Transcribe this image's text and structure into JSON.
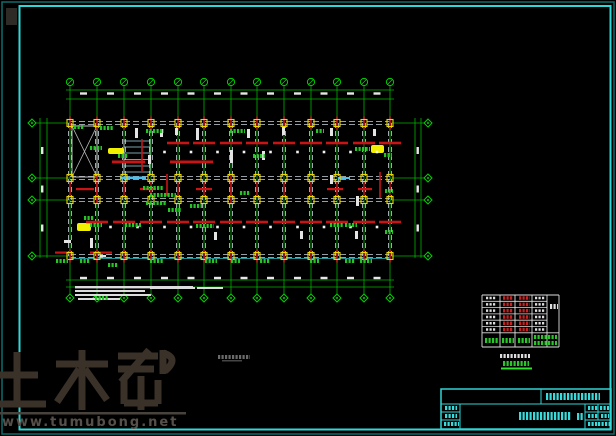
{
  "watermark": {
    "logo_text": "土木帮",
    "site_url": "www.tumubong.net",
    "logo_color": "#3a3129",
    "url_color": "#57504a"
  },
  "frame": {
    "background": "#000000",
    "outer_color": "#0e6e6e",
    "inner_color": "#2fd8d8"
  },
  "drawing": {
    "grid_x": [
      70,
      97,
      124,
      151,
      178,
      204,
      231,
      257,
      284,
      311,
      337,
      364,
      390
    ],
    "row_y": [
      123,
      178,
      200,
      256
    ],
    "plan": {
      "x1": 70,
      "y1": 123,
      "x2": 390,
      "y2": 256
    },
    "bubbles": {
      "top_y": 82,
      "bottom_y": 298,
      "left_x": 32,
      "right_x": 428,
      "top_count": 13,
      "bottom_count": 13,
      "left_count": 4,
      "right_count": 4
    },
    "colors": {
      "grid_green": "#00b400",
      "bubble_green": "#00d000",
      "plan_outline": "#c9d2dc",
      "beam_red": "#c81414",
      "column_yellow": "#ecd800",
      "highlight_yellow": "#f0f000",
      "highlight_cyan": "#49c0ee",
      "annotation_green": "#27c427",
      "annotation_white": "#e4e4e4",
      "notes_white": "#dcdcdc",
      "scale_note_gray": "#6a6a6a"
    }
  },
  "schedule_table": {
    "columns": 5,
    "data_rows": 6,
    "border_color": "#dddddd",
    "red_text": "#cc2020",
    "green_text": "#28c828",
    "white_text": "#dddddd",
    "underline_color": "#2ee22e"
  },
  "title_block": {
    "line_color": "#2fd4d4",
    "text_color": "#38dcdc"
  }
}
